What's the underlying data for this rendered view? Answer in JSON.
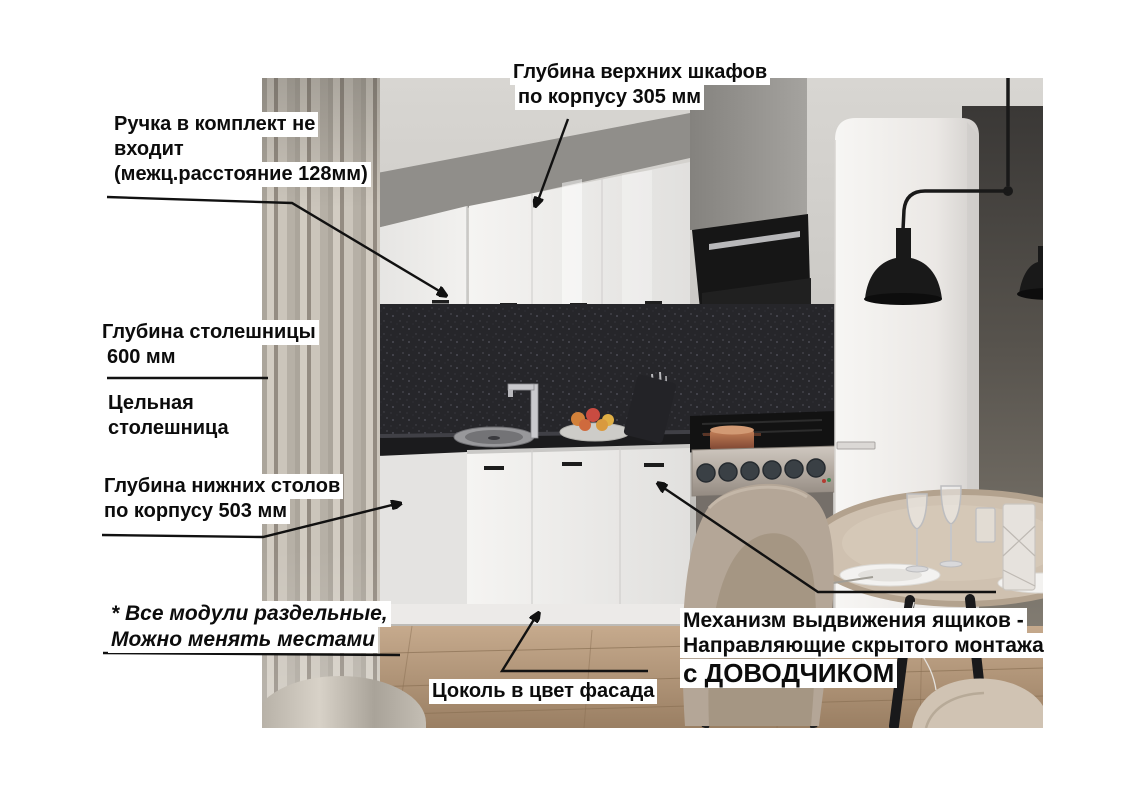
{
  "annotations": {
    "upper_cabinet_depth": {
      "line1": "Глубина верхних шкафов",
      "line2": "по корпусу 305 мм"
    },
    "handle_note": {
      "line1": "Ручка в комплект не",
      "line2": "входит",
      "line3": "(межц.расстояние 128мм)"
    },
    "countertop_depth": {
      "line1": "Глубина столешницы",
      "line2": "600 мм"
    },
    "solid_countertop": {
      "line1": "Цельная",
      "line2": "столешница"
    },
    "base_cabinet_depth": {
      "line1": "Глубина нижних столов",
      "line2": "по корпусу 503 мм"
    },
    "modules_note": {
      "line1": "* Все модули раздельные,",
      "line2": "Можно менять местами"
    },
    "plinth_note": {
      "text": "Цоколь в цвет фасада"
    },
    "drawer_mechanism": {
      "line1": "Механизм выдвижения ящиков -",
      "line2": "Направляющие скрытого монтажа",
      "line3": "с ДОВОДЧИКОМ"
    }
  },
  "measurements": {
    "upper_cabinet_depth_mm": "305",
    "handle_spacing_mm": "128",
    "countertop_depth_mm": "600",
    "base_cabinet_depth_mm": "503"
  },
  "colors": {
    "page_bg": "#ffffff",
    "annotation_text": "#0c0c0c",
    "annotation_bg": "#ffffff",
    "arrow": "#111111",
    "cabinet_white": "#f3f2f0",
    "backsplash_dark": "#26262a",
    "hood_black": "#161616",
    "floor_wood": "#b2977b",
    "curtain_beige": "#c2bcb2",
    "wall_dark": "#57534d"
  }
}
